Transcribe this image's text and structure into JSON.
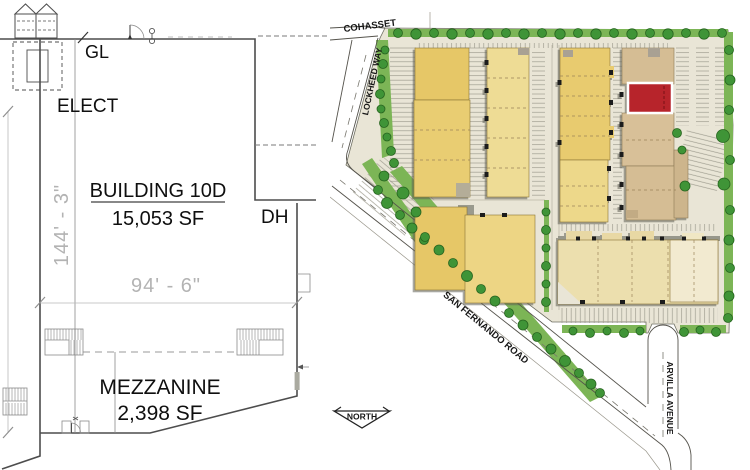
{
  "floorplan": {
    "labels": {
      "gl": "GL",
      "elect": "ELECT",
      "dh": "DH",
      "building_name": "BUILDING 10D",
      "building_area": "15,053 SF",
      "mezzanine_name": "MEZZANINE",
      "mezzanine_area": "2,398 SF"
    },
    "dimensions": {
      "height": "144' - 3\"",
      "width": "94' - 6\""
    }
  },
  "siteplan": {
    "streets": {
      "top": "COHASSET",
      "left": "LOCKHEED WAY",
      "diagonal": "SAN FERNANDO ROAD",
      "right": "ARVILLA AVENUE"
    },
    "compass": "NORTH",
    "colors": {
      "highlight_red": "#b7242b",
      "building_yellow": "#e6c767",
      "building_yellow_light": "#eedc95",
      "building_tan": "#d5bd94",
      "building_cream": "#ecdfae",
      "tree_green": "#3f9437",
      "hedge_green": "#7cb556",
      "site_ground": "#e9e5d6"
    }
  }
}
